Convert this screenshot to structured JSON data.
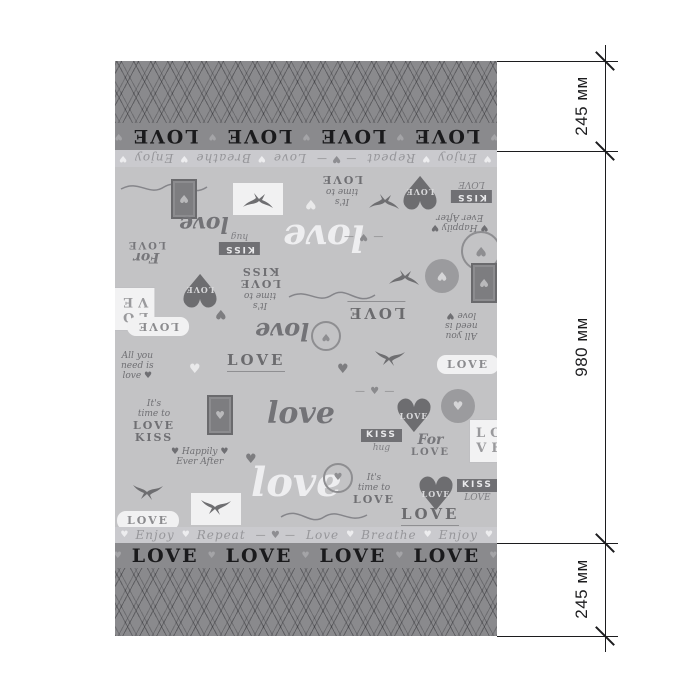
{
  "fabric": {
    "border_word": "LOVE",
    "border_word_repeat": 6,
    "border_separator": "♥",
    "strip": {
      "words": [
        "Love",
        "Breathe",
        "Enjoy",
        "Repeat"
      ],
      "heart": "♥",
      "divider": "— ♥ —",
      "repeat": 2
    },
    "heart_glyph": "♥",
    "colors": {
      "field_bg": "#c3c3c5",
      "strip_bg": "#cacace",
      "band_bg": "#8a8a8d",
      "border_text": "#1a1a1c",
      "motif_dark": "#6f6f73",
      "motif_white": "#f1f1f2"
    },
    "motifs": [
      {
        "t": "flourish",
        "x": 4,
        "y": 8,
        "flip": true
      },
      {
        "t": "stamp",
        "x": 56,
        "y": 12,
        "flip": true,
        "glyph": "♥"
      },
      {
        "t": "etch",
        "x": 118,
        "y": 16,
        "flip": true
      },
      {
        "t": "stack",
        "lines": [
          "It's",
          "time to",
          "LOVE"
        ],
        "x": 206,
        "y": 6,
        "flip": true
      },
      {
        "t": "heart",
        "x": 282,
        "y": 4,
        "flip": true,
        "text": "LOVE",
        "glyph": "♥"
      },
      {
        "t": "kiss",
        "lines": [
          "KISS",
          "LOVE"
        ],
        "x": 336,
        "y": 12,
        "flip": true
      },
      {
        "t": "swallow",
        "x": 252,
        "y": 22,
        "flip": true
      },
      {
        "t": "heartsm",
        "x": 190,
        "y": 30,
        "flip": true,
        "white": true,
        "glyph": "♥"
      },
      {
        "t": "script",
        "text": "love",
        "x": 64,
        "y": 46,
        "size": 22,
        "flip": true
      },
      {
        "t": "stack",
        "lines": [
          "♥ Happily ♥",
          "Ever After"
        ],
        "x": 316,
        "y": 44,
        "flip": true
      },
      {
        "t": "forlove",
        "lines": [
          "For",
          "LOVE"
        ],
        "x": 12,
        "y": 72,
        "flip": true
      },
      {
        "t": "kiss",
        "lines": [
          "KISS",
          "hug"
        ],
        "x": 104,
        "y": 64,
        "flip": true
      },
      {
        "t": "script",
        "text": "love",
        "x": 168,
        "y": 52,
        "size": 36,
        "white": true,
        "flip": true
      },
      {
        "t": "wreath",
        "x": 346,
        "y": 64,
        "flip": true,
        "glyph": "♥"
      },
      {
        "t": "arrowheart",
        "text": "— ♥ —",
        "x": 228,
        "y": 64,
        "flip": true
      },
      {
        "t": "frame",
        "lines": [
          "LO",
          "VE"
        ],
        "x": -4,
        "y": 120,
        "flip": true
      },
      {
        "t": "heart",
        "x": 62,
        "y": 102,
        "flip": true,
        "text": "LOVE",
        "glyph": "♥"
      },
      {
        "t": "stack",
        "lines": [
          "It's",
          "time to",
          "LOVE",
          "KISS"
        ],
        "x": 124,
        "y": 98,
        "flip": true
      },
      {
        "t": "flourish",
        "x": 172,
        "y": 116,
        "flip": true
      },
      {
        "t": "swallow",
        "x": 272,
        "y": 98,
        "flip": true
      },
      {
        "t": "crest",
        "x": 310,
        "y": 92,
        "flip": true,
        "glyph": "♥"
      },
      {
        "t": "stamp",
        "x": 356,
        "y": 96,
        "flip": true,
        "glyph": "♥"
      },
      {
        "t": "banner",
        "text": "LOVE",
        "x": 232,
        "y": 134,
        "flip": true
      },
      {
        "t": "pill",
        "text": "LOVE",
        "x": 12,
        "y": 150,
        "flip": true
      },
      {
        "t": "stack",
        "lines": [
          "All you",
          "need is",
          "love ♥"
        ],
        "x": 330,
        "y": 142,
        "flip": true
      },
      {
        "t": "script",
        "text": "love",
        "x": 140,
        "y": 152,
        "size": 24,
        "flip": true
      },
      {
        "t": "heartsm",
        "x": 100,
        "y": 140,
        "flip": true,
        "glyph": "♥"
      },
      {
        "t": "wreath",
        "x": 196,
        "y": 154,
        "flip": true,
        "small": true,
        "glyph": "♥"
      },
      {
        "t": "stack",
        "lines": [
          "All you",
          "need is",
          "love ♥"
        ],
        "x": 6,
        "y": 184
      },
      {
        "t": "banner",
        "text": "LOVE",
        "x": 112,
        "y": 186
      },
      {
        "t": "heartsm",
        "x": 74,
        "y": 196,
        "white": true,
        "glyph": "♥"
      },
      {
        "t": "swallow",
        "x": 258,
        "y": 182
      },
      {
        "t": "pill",
        "text": "LOVE",
        "x": 322,
        "y": 188
      },
      {
        "t": "heartsm",
        "x": 222,
        "y": 196,
        "glyph": "♥"
      },
      {
        "t": "stack",
        "lines": [
          "It's",
          "time to",
          "LOVE",
          "KISS"
        ],
        "x": 18,
        "y": 232
      },
      {
        "t": "stamp",
        "x": 92,
        "y": 228,
        "glyph": "♥"
      },
      {
        "t": "script",
        "text": "love",
        "x": 152,
        "y": 232,
        "size": 30
      },
      {
        "t": "arrowheart",
        "text": "— ♥ —",
        "x": 240,
        "y": 220
      },
      {
        "t": "heart",
        "x": 276,
        "y": 226,
        "text": "LOVE",
        "glyph": "♥"
      },
      {
        "t": "crest",
        "x": 326,
        "y": 222,
        "glyph": "♥"
      },
      {
        "t": "frame",
        "lines": [
          "LO",
          "VE"
        ],
        "x": 354,
        "y": 252
      },
      {
        "t": "kiss",
        "lines": [
          "KISS",
          "hug"
        ],
        "x": 246,
        "y": 262
      },
      {
        "t": "forlove",
        "lines": [
          "For",
          "LOVE"
        ],
        "x": 296,
        "y": 266
      },
      {
        "t": "stack",
        "lines": [
          "♥ Happily ♥",
          "Ever After"
        ],
        "x": 56,
        "y": 280
      },
      {
        "t": "heartsm",
        "x": 130,
        "y": 286,
        "glyph": "♥"
      },
      {
        "t": "script",
        "text": "love",
        "x": 136,
        "y": 296,
        "size": 40,
        "white": true
      },
      {
        "t": "wreath",
        "x": 208,
        "y": 296,
        "small": true,
        "glyph": "♥"
      },
      {
        "t": "swallow",
        "x": 16,
        "y": 316
      },
      {
        "t": "stack",
        "lines": [
          "It's",
          "time to",
          "LOVE"
        ],
        "x": 238,
        "y": 306
      },
      {
        "t": "heart",
        "x": 298,
        "y": 304,
        "text": "LOVE",
        "glyph": "♥"
      },
      {
        "t": "kiss",
        "lines": [
          "KISS",
          "LOVE"
        ],
        "x": 342,
        "y": 312
      },
      {
        "t": "etch",
        "x": 76,
        "y": 326
      },
      {
        "t": "flourish",
        "x": 164,
        "y": 342
      },
      {
        "t": "banner",
        "text": "LOVE",
        "x": 286,
        "y": 340
      },
      {
        "t": "pill",
        "text": "LOVE",
        "x": 2,
        "y": 344
      }
    ]
  },
  "dimensions": {
    "unit_note": "мм",
    "top": {
      "label": "245 мм"
    },
    "middle": {
      "label": "980 мм"
    },
    "bottom": {
      "label": "245 мм"
    },
    "line_color": "#1c1c1e"
  }
}
